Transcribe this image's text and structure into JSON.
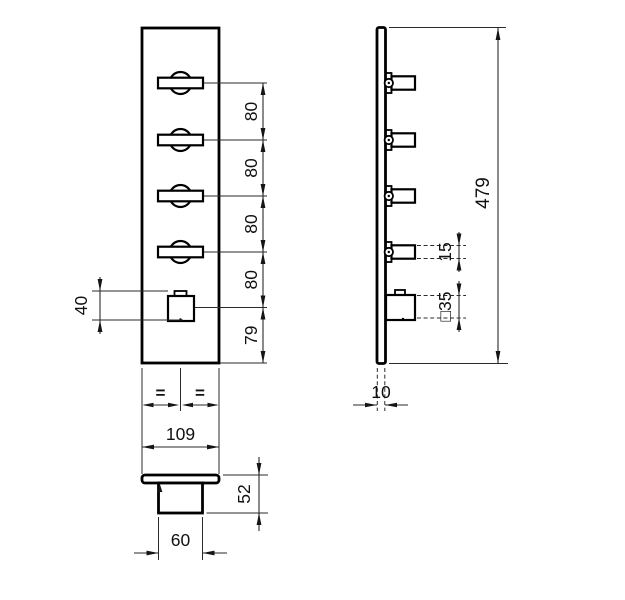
{
  "drawing": {
    "front": {
      "spacing_dims": [
        "80",
        "80",
        "80",
        "80",
        "79"
      ],
      "button_height_dim": "40",
      "equal_marks": [
        "=",
        "="
      ],
      "width_dim": "109"
    },
    "side": {
      "overall_height_dim": "479",
      "handle_depth_dim": "15",
      "button_face_dim": "□35",
      "plate_thickness_dim": "10"
    },
    "bottom": {
      "total_depth_dim": "52",
      "button_width_dim": "60"
    },
    "colors": {
      "ink": "#111111",
      "background": "#ffffff"
    }
  }
}
